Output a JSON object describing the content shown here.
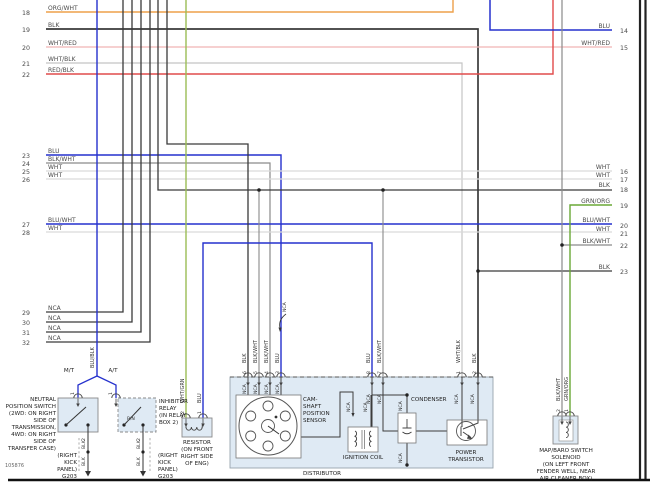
{
  "footer": {
    "doc_number": "105876"
  },
  "left_wires": [
    {
      "num": "18",
      "label": "ORG/WHT"
    },
    {
      "num": "19",
      "label": "BLK"
    },
    {
      "num": "20",
      "label": "WHT/RED"
    },
    {
      "num": "21",
      "label": "WHT/BLK"
    },
    {
      "num": "22",
      "label": "RED/BLK"
    },
    {
      "num": "23",
      "label": "BLU"
    },
    {
      "num": "24",
      "label": "BLK/WHT"
    },
    {
      "num": "25",
      "label": "WHT"
    },
    {
      "num": "26",
      "label": "WHT"
    },
    {
      "num": "27",
      "label": "BLU/WHT"
    },
    {
      "num": "28",
      "label": "WHT"
    },
    {
      "num": "29",
      "label": "NCA"
    },
    {
      "num": "30",
      "label": "NCA"
    },
    {
      "num": "31",
      "label": "NCA"
    },
    {
      "num": "32",
      "label": "NCA"
    }
  ],
  "right_wires": [
    {
      "num": "14",
      "label": "BLU"
    },
    {
      "num": "15",
      "label": "WHT/RED"
    },
    {
      "num": "16",
      "label": "WHT"
    },
    {
      "num": "17",
      "label": "WHT"
    },
    {
      "num": "18",
      "label": "BLK"
    },
    {
      "num": "19",
      "label": "GRN/ORG"
    },
    {
      "num": "20",
      "label": "BLU/WHT"
    },
    {
      "num": "21",
      "label": "WHT"
    },
    {
      "num": "22",
      "label": "BLK/WHT"
    },
    {
      "num": "23",
      "label": "BLK"
    }
  ],
  "tags": {
    "nca": "NCA",
    "blk": "BLK",
    "blk_wht": "BLK/WHT",
    "blu": "BLU",
    "wht_blk": "WHT/BLK",
    "grn_org": "GRN/ORG",
    "wht_grn": "WHT/GRN",
    "blu_blk": "BLU/BLK",
    "mt": "M/T",
    "at": "A/T",
    "pn": "P/N",
    "g203": "G203"
  },
  "pins": {
    "p1": "1",
    "p2": "2",
    "p3": "3",
    "p4": "4",
    "p5": "5",
    "p6": "6",
    "p7": "7",
    "p8": "8"
  },
  "components": {
    "neutral_switch": {
      "lines": [
        "NEUTRAL",
        "POSITION SWITCH",
        "(2WD: ON RIGHT",
        "SIDE OF",
        "TRANSMISSION,",
        "4WD: ON RIGHT",
        "SIDE OF",
        "TRANSFER CASE)"
      ]
    },
    "inhibitor_relay": {
      "lines": [
        "INHIBITOR",
        "RELAY",
        "(IN RELAY",
        "BOX 2)"
      ]
    },
    "kick_panel": {
      "lines": [
        "(RIGHT",
        "KICK",
        "PANEL)"
      ]
    },
    "resistor": {
      "lines": [
        "RESISTOR",
        "(ON FRONT",
        "RIGHT SIDE",
        "OF ENG)"
      ]
    },
    "map_baro": {
      "lines": [
        "MAP/BARO SWITCH",
        "SOLENOID",
        "(ON LEFT FRONT",
        "FENDER WELL, NEAR",
        "AIR CLEANER BOX)"
      ]
    },
    "distributor": {
      "label": "DISTRIBUTOR",
      "cam_sensor": {
        "lines": [
          "CAM-",
          "SHAFT",
          "POSITION",
          "SENSOR"
        ]
      },
      "ignition_coil": {
        "label": "IGNITION COIL"
      },
      "condenser": {
        "label": "CONDENSER"
      },
      "power_transistor": {
        "lines": [
          "POWER",
          "TRANSISTOR"
        ]
      }
    }
  },
  "colors": {
    "blu": "#2531cd",
    "blk": "#3a3a3a",
    "blk_wht": "#8a8a8a",
    "wht": "#d9d9d9",
    "wht_blk": "#c4c4c4",
    "wht_red": "#f0b4b4",
    "red_blk": "#e14b4b",
    "org_wht": "#eda04a",
    "grn_org": "#6aa836",
    "wht_grn": "#9bbd55",
    "dark": "#444444",
    "box_fill": "#dfeaf4"
  }
}
